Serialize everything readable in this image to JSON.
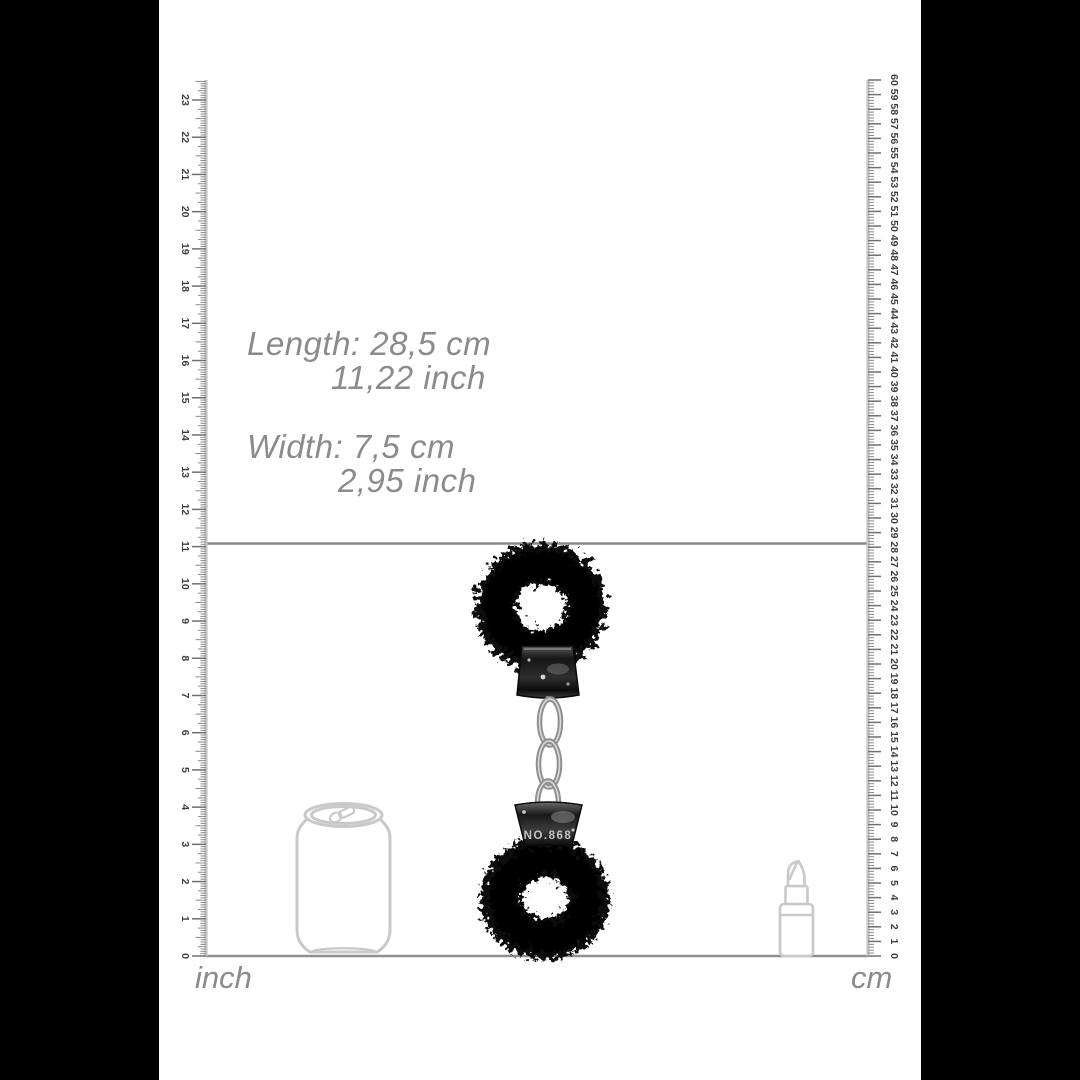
{
  "dimensions_label": {
    "length_line1": "Length: 28,5 cm",
    "length_line2": "11,22 inch",
    "width_line1": "Width: 7,5 cm",
    "width_line2": "2,95 inch"
  },
  "measurement": {
    "length_cm": 28.5,
    "length_inch": 11.22,
    "width_cm": 7.5,
    "width_inch": 2.95
  },
  "rulers": {
    "left": {
      "unit_label": "inch",
      "values": [
        0,
        1,
        2,
        3,
        4,
        5,
        6,
        7,
        8,
        9,
        10,
        11,
        12,
        13,
        14,
        15,
        16,
        17,
        18,
        19,
        20,
        21,
        22,
        23
      ]
    },
    "right": {
      "unit_label": "cm",
      "values": [
        0,
        1,
        2,
        3,
        4,
        5,
        6,
        7,
        8,
        9,
        10,
        11,
        12,
        13,
        14,
        15,
        16,
        17,
        18,
        19,
        20,
        21,
        22,
        23,
        24,
        25,
        26,
        27,
        28,
        29,
        30,
        31,
        32,
        33,
        34,
        35,
        36,
        37,
        38,
        39,
        40,
        41,
        42,
        43,
        44,
        45,
        46,
        47,
        48,
        49,
        50,
        51,
        52,
        53,
        54,
        55,
        56,
        57,
        58,
        59,
        60
      ]
    }
  },
  "product": {
    "name": "black furry handcuffs",
    "stamp_text": "NO.868"
  },
  "reference_objects": [
    "soda-can",
    "lipstick"
  ],
  "colors": {
    "background": "#000000",
    "panel": "#ffffff",
    "ruler_line": "#c6c6c6",
    "tick": "#8a8a8a",
    "tick_label": "#3d3d3d",
    "dimension_text": "#8b8b8d",
    "guide_line": "#878787",
    "outline_objects": "#c9c9c9",
    "product_black": "#0a0a0a",
    "metal": "#9a9a9a"
  }
}
